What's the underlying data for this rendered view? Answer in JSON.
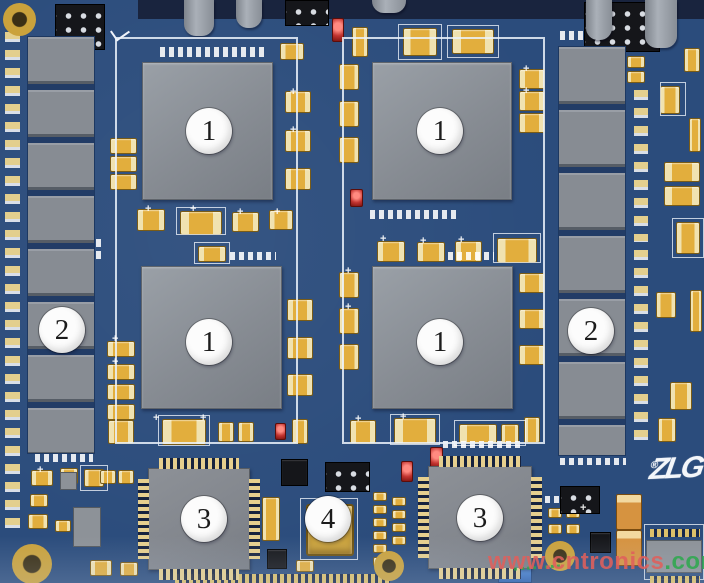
{
  "callouts": {
    "bga_top_left": "1",
    "bga_top_right": "1",
    "bga_bottom_left": "1",
    "bga_bottom_right": "1",
    "memory_left": "2",
    "memory_right": "2",
    "qfp_left": "3",
    "qfp_right": "3",
    "power_module": "4"
  },
  "logo": {
    "text": "ZLG",
    "mark": "®"
  },
  "watermark": {
    "part1": "www.cntronics",
    "part2": ".com"
  },
  "colors": {
    "pcb_blue": "#2b4c7c",
    "pcb_dark": "#19243e",
    "chip_gray": "#878c93",
    "chip_gray_light": "#9aa0a7",
    "cap_gold": "#e2ae3d",
    "cap_gold_light": "#f0e2b0",
    "lead_gold": "#e6cf8e",
    "silkscreen": "#edf2fa",
    "callout_bg": "#fcfcfc",
    "callout_text": "#1c1c1c",
    "watermark_red": "#e0605c",
    "watermark_green": "#2fa84f",
    "logo_white": "#f3f6fa",
    "led_red": "#c23430",
    "black_part": "#15161a"
  }
}
